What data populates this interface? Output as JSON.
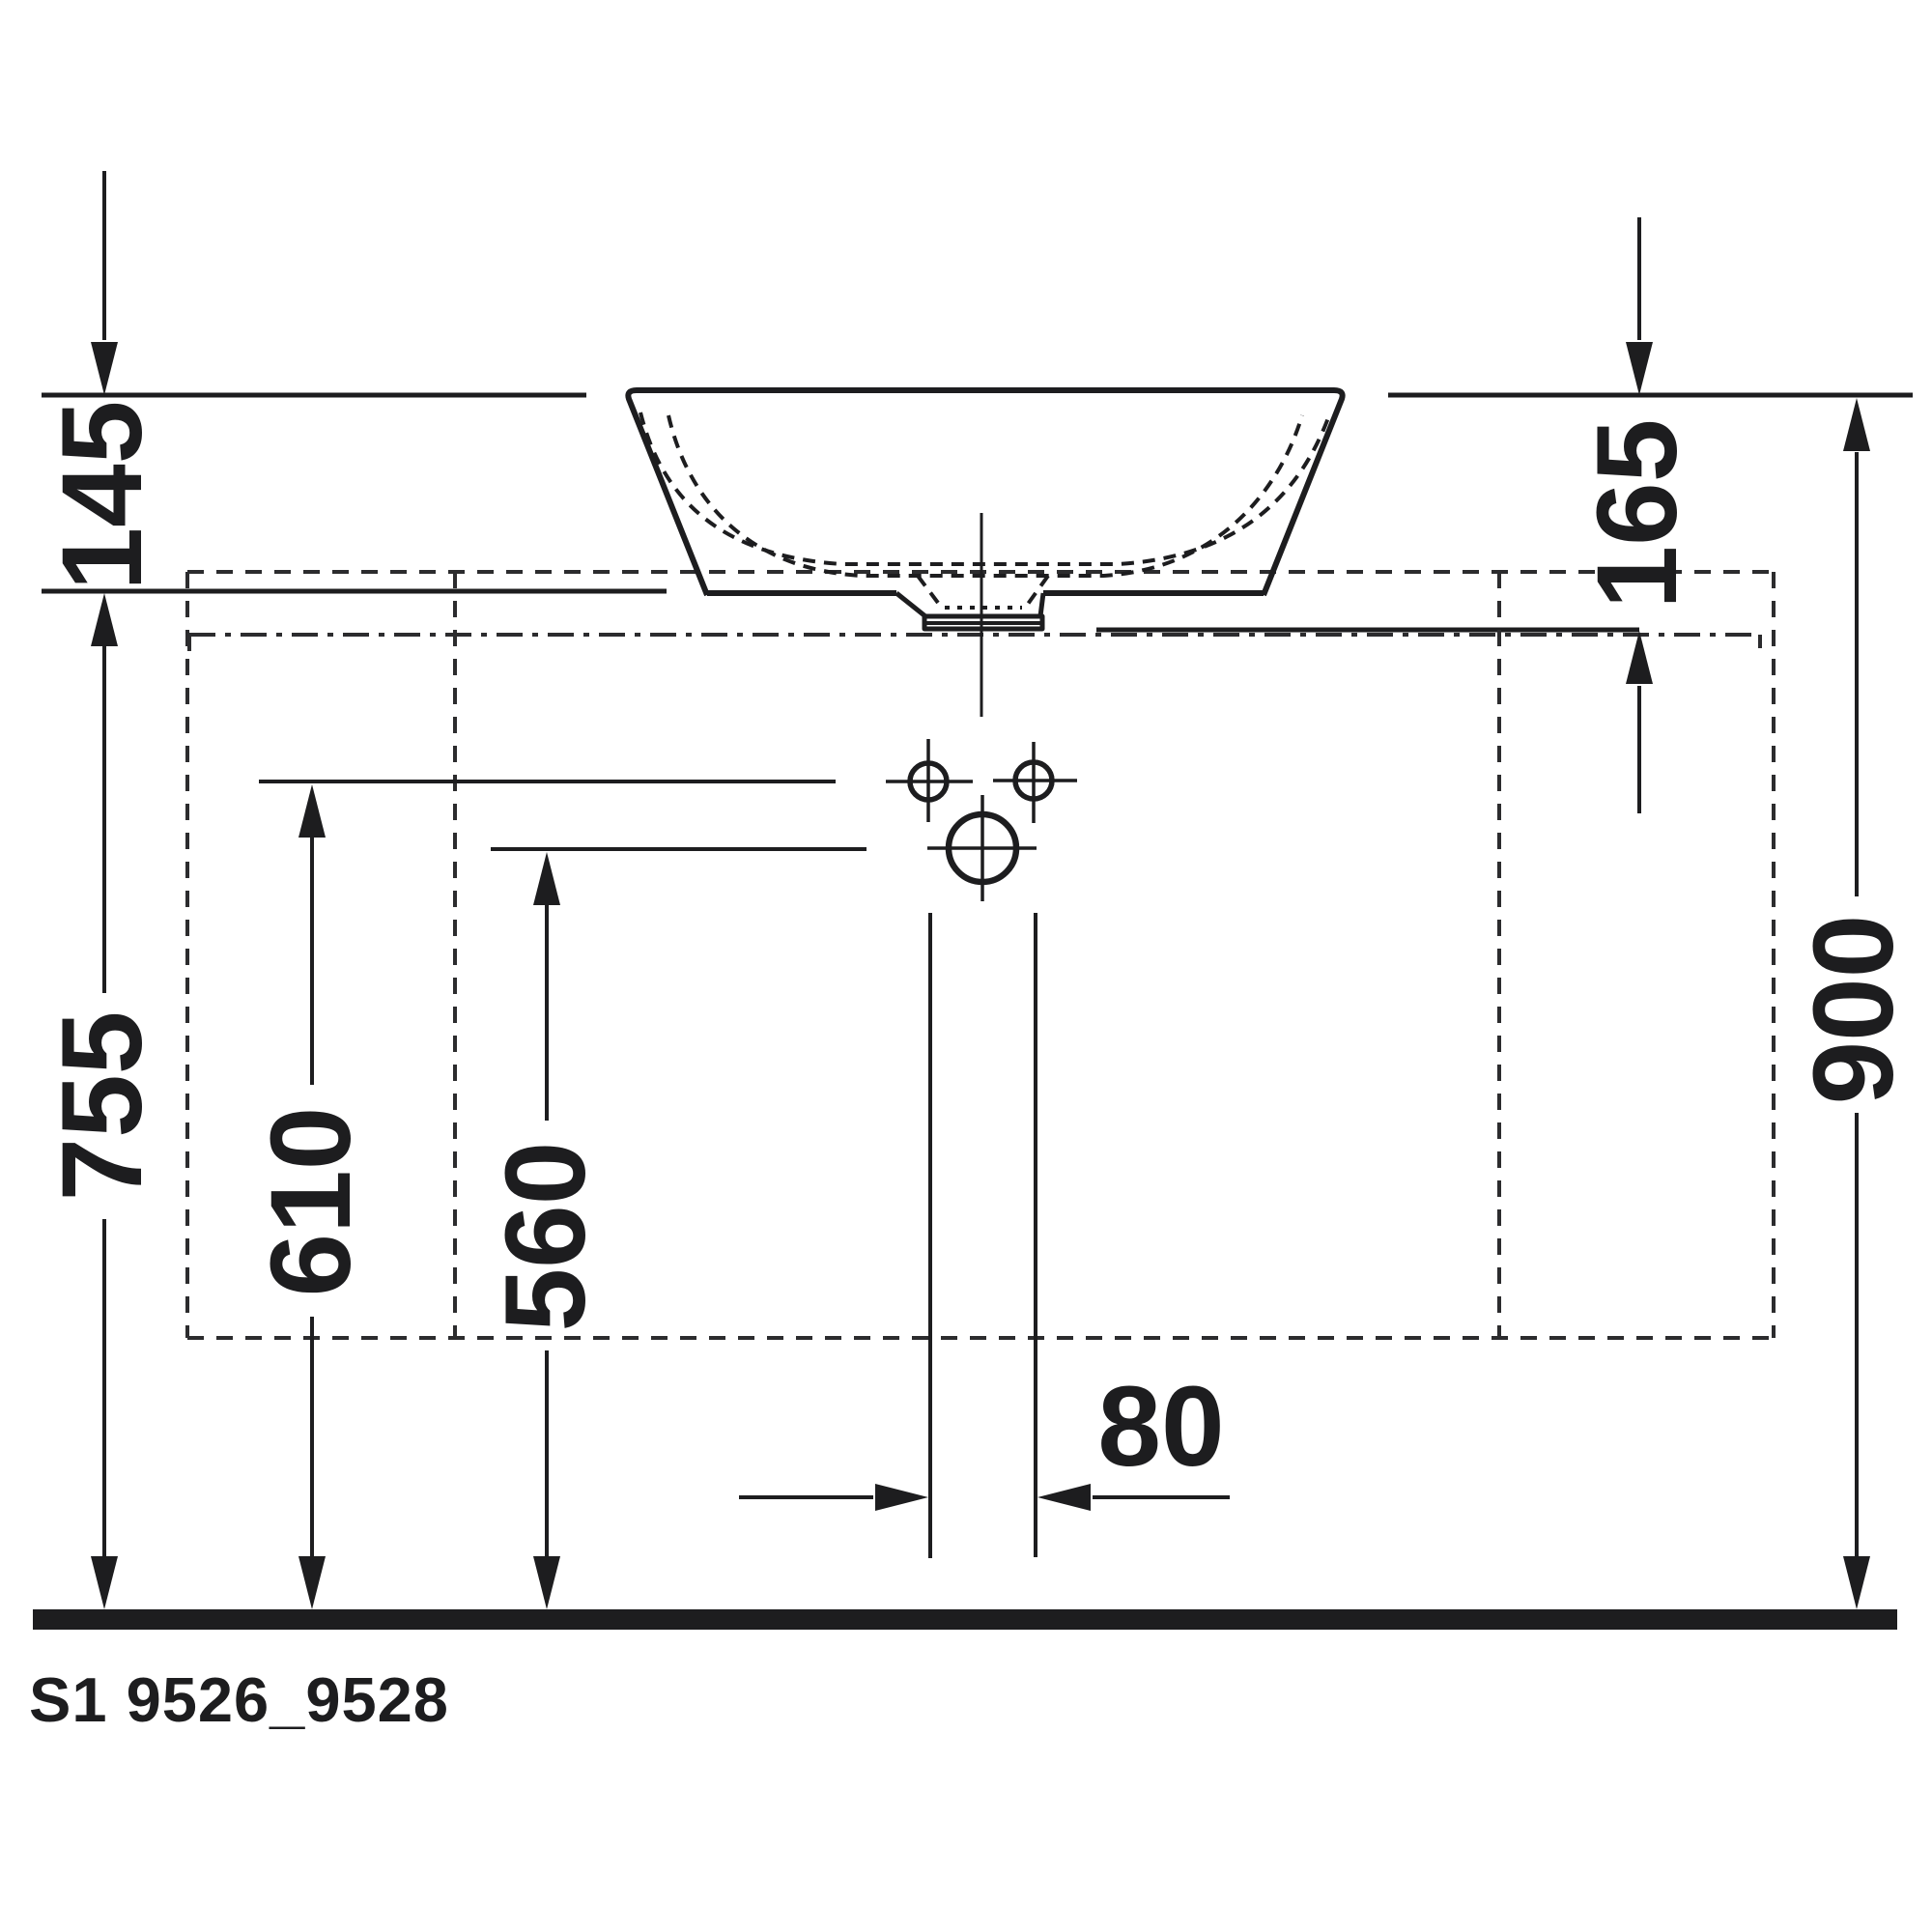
{
  "colors": {
    "line": "#1d1d1f",
    "dashed_line": "#2c2c2e",
    "background": "#ffffff"
  },
  "labels": {
    "dim_145": "145",
    "dim_165": "165",
    "dim_755": "755",
    "dim_610": "610",
    "dim_560": "560",
    "dim_80": "80",
    "dim_900": "900"
  },
  "title": {
    "code": "S1 9526_9528"
  }
}
